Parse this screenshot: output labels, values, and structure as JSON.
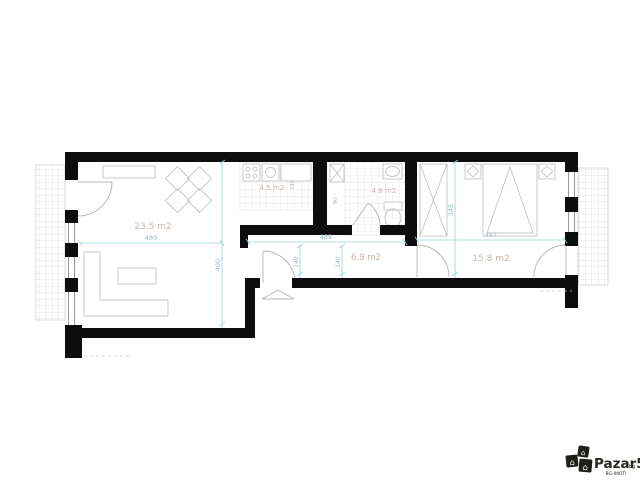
{
  "plan": {
    "type": "apartment-floor-plan",
    "rooms": [
      {
        "id": "living-room",
        "area_label": "23.5 m2"
      },
      {
        "id": "kitchen",
        "area_label": "4.5 m2"
      },
      {
        "id": "bathroom",
        "area_label": "4.8 m2"
      },
      {
        "id": "hallway",
        "area_label": "6.9 m2"
      },
      {
        "id": "bedroom",
        "area_label": "15.8 m2"
      }
    ],
    "dimensions": {
      "living_width": "480",
      "living_depth": "400",
      "hall_width": "488",
      "hall_opening_left": "140",
      "hall_opening_right": "140",
      "bedroom_width": "457",
      "bedroom_depth": "345",
      "kitchen_side": "180",
      "shaft_side": "90"
    },
    "colors": {
      "wall": "#0d0d0d",
      "dimension_line": "#9fd0da",
      "dimension_text": "#9bb8c0",
      "room_label": "#c9b4ac",
      "furniture_line": "#c4c4c4",
      "tile_line": "#e2e2e2"
    }
  },
  "watermark": {
    "brand": "Pazar5",
    "suffix": "bg",
    "tagline": "BG-IMOTI",
    "logo_icon": "house-icon"
  }
}
